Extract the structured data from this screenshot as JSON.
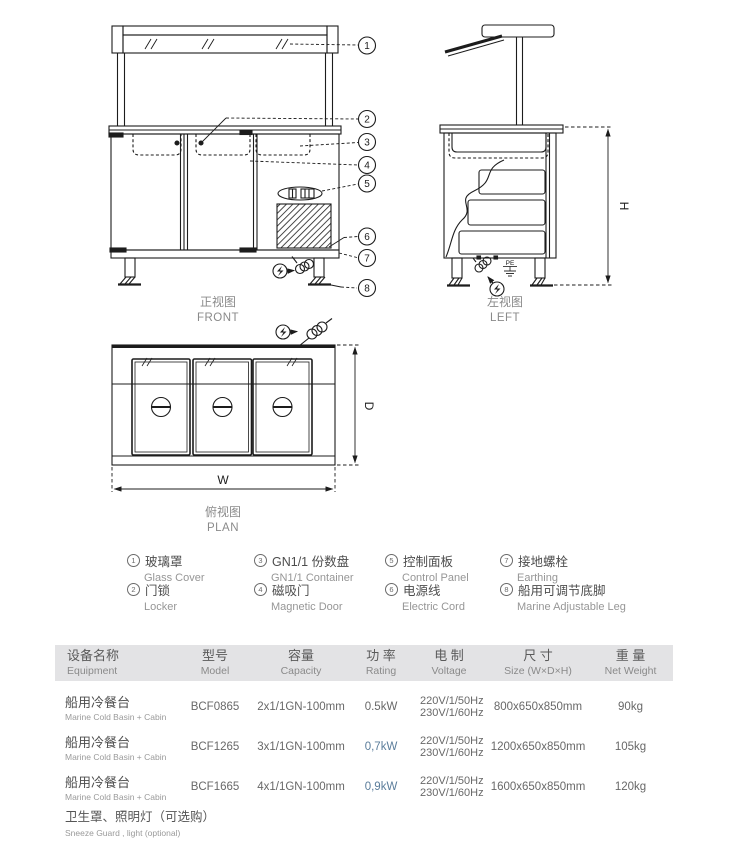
{
  "views": {
    "front": {
      "label_cn": "正视图",
      "label_en": "FRONT",
      "callouts": [
        "1",
        "2",
        "3",
        "4",
        "5",
        "6",
        "7",
        "8"
      ]
    },
    "left": {
      "label_cn": "左视图",
      "label_en": "LEFT",
      "dim_h": "H",
      "pe_label": "PE"
    },
    "plan": {
      "label_cn": "俯视图",
      "label_en": "PLAN",
      "dim_w": "W",
      "dim_d": "D"
    }
  },
  "legend": {
    "items": [
      {
        "num": "1",
        "cn": "玻璃罩",
        "en": "Glass Cover"
      },
      {
        "num": "2",
        "cn": "门锁",
        "en": "Locker"
      },
      {
        "num": "3",
        "cn": "GN1/1 份数盘",
        "en": "GN1/1 Container"
      },
      {
        "num": "4",
        "cn": "磁吸门",
        "en": "Magnetic Door"
      },
      {
        "num": "5",
        "cn": "控制面板",
        "en": "Control Panel"
      },
      {
        "num": "6",
        "cn": "电源线",
        "en": "Electric Cord"
      },
      {
        "num": "7",
        "cn": "接地螺栓",
        "en": "Earthing"
      },
      {
        "num": "8",
        "cn": "船用可调节底脚",
        "en": "Marine Adjustable Leg"
      }
    ]
  },
  "table": {
    "headers": [
      {
        "cn": "设备名称",
        "en": "Equipment"
      },
      {
        "cn": "型号",
        "en": "Model"
      },
      {
        "cn": "容量",
        "en": "Capacity"
      },
      {
        "cn": "功 率",
        "en": "Rating"
      },
      {
        "cn": "电 制",
        "en": "Voltage"
      },
      {
        "cn": "尺 寸",
        "en": "Size (W×D×H)"
      },
      {
        "cn": "重 量",
        "en": "Net Weight"
      }
    ],
    "rows": [
      {
        "name_cn": "船用冷餐台",
        "name_en": "Marine Cold Basin + Cabin",
        "model": "BCF0865",
        "capacity": "2x1/1GN-100mm",
        "rating": "0.5kW",
        "voltage1": "220V/1/50Hz",
        "voltage2": "230V/1/60Hz",
        "size": "800x650x850mm",
        "weight": "90kg"
      },
      {
        "name_cn": "船用冷餐台",
        "name_en": "Marine Cold Basin + Cabin",
        "model": "BCF1265",
        "capacity": "3x1/1GN-100mm",
        "rating": "0,7kW",
        "voltage1": "220V/1/50Hz",
        "voltage2": "230V/1/60Hz",
        "size": "1200x650x850mm",
        "weight": "105kg"
      },
      {
        "name_cn": "船用冷餐台",
        "name_en": "Marine Cold Basin + Cabin",
        "model": "BCF1665",
        "capacity": "4x1/1GN-100mm",
        "rating": "0,9kW",
        "voltage1": "220V/1/50Hz",
        "voltage2": "230V/1/60Hz",
        "size": "1600x650x850mm",
        "weight": "120kg"
      }
    ],
    "footnote_cn": "卫生罩、照明灯（可选购）",
    "footnote_en": "Sneeze Guard , light (optional)"
  },
  "colors": {
    "line": "#1c1c1c",
    "label_gray": "#8a8a8a",
    "header_bg": "#e3e3e5",
    "rating_alt": "#5b7d9b"
  }
}
